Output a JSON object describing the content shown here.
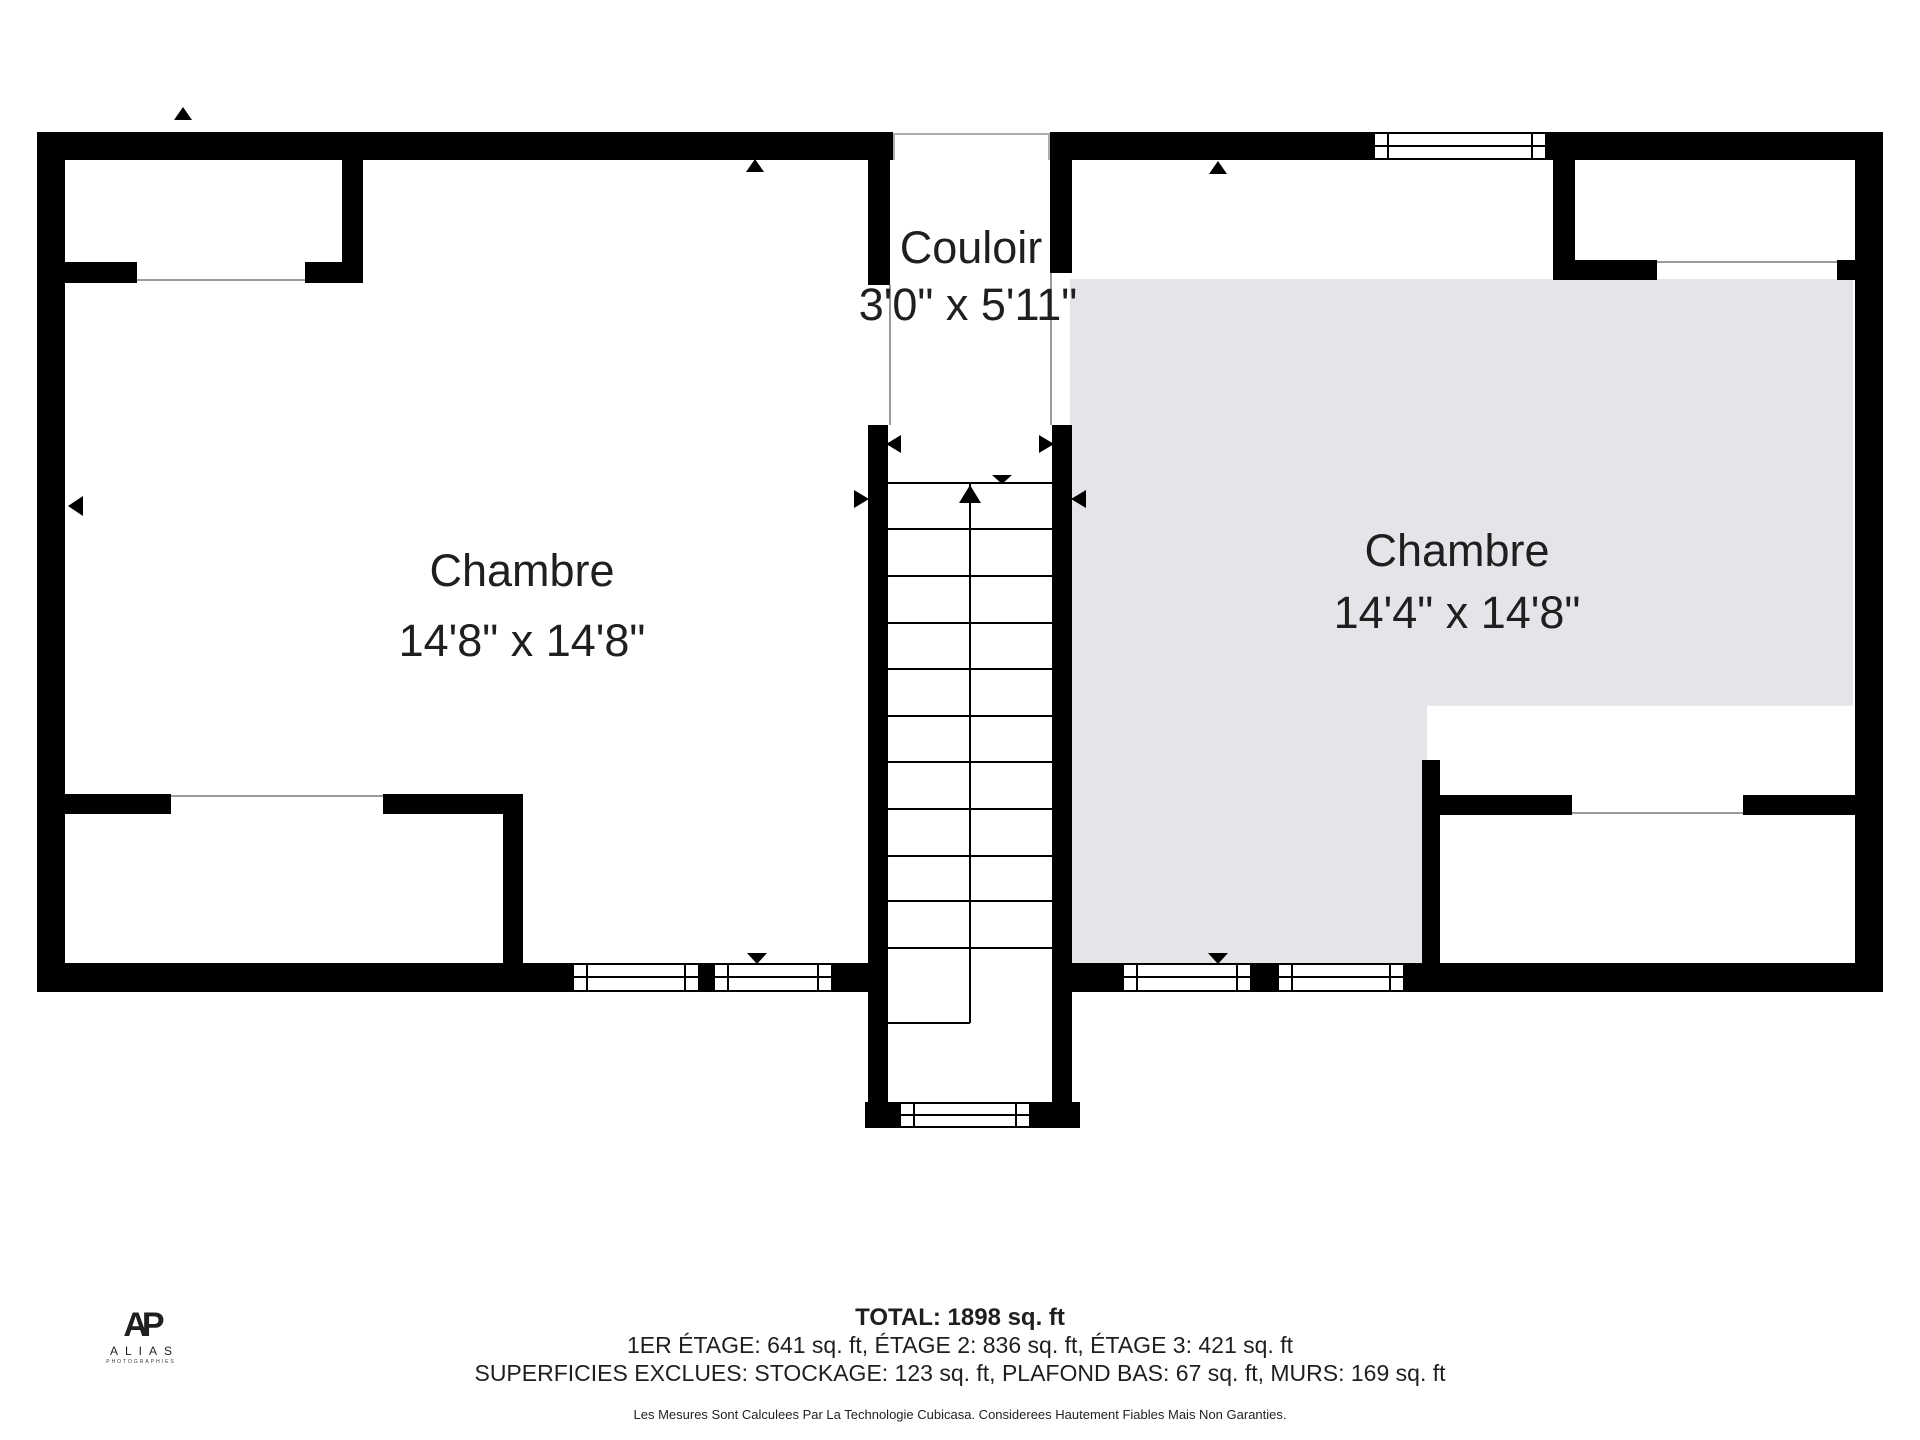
{
  "plan": {
    "type": "floorplan",
    "rooms": {
      "left_bedroom": {
        "name": "Chambre",
        "dimensions": "14'8\" x 14'8\""
      },
      "right_bedroom": {
        "name": "Chambre",
        "dimensions": "14'4\" x 14'8\""
      },
      "hallway": {
        "name": "Couloir",
        "dimensions": "3'0\" x 5'11\""
      }
    },
    "colors": {
      "wall": "#000000",
      "room_highlight": "#e4e4e9",
      "thin_line": "#9b9b9b",
      "text": "#1f1f1f"
    }
  },
  "summary": {
    "total": "TOTAL: 1898 sq. ft",
    "floors": "1ER ÉTAGE: 641 sq. ft, ÉTAGE 2: 836 sq. ft, ÉTAGE 3: 421 sq. ft",
    "exclusions": "SUPERFICIES EXCLUES: STOCKAGE: 123 sq. ft, PLAFOND BAS: 67 sq. ft, MURS: 169 sq. ft",
    "disclaimer": "Les Mesures Sont Calculees Par La Technologie Cubicasa. Considerees Hautement Fiables Mais Non Garanties."
  },
  "logo": {
    "monogram": "AP",
    "name": "ALIAS",
    "tagline": "PHOTOGRAPHIES"
  }
}
